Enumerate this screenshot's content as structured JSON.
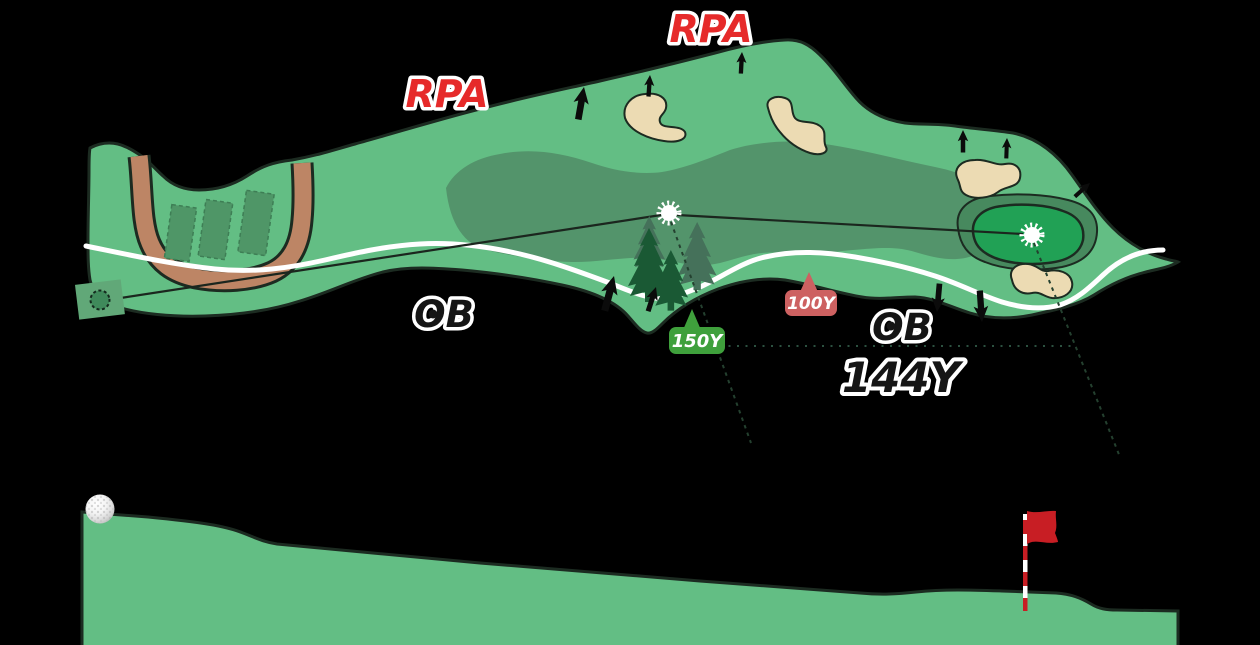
{
  "scene": {
    "background": "#000000",
    "description": "Golf hole layout: overhead course map with yardage guides and side elevation profile"
  },
  "map": {
    "rpa_labels": [
      {
        "text": "RPA"
      },
      {
        "text": "RPA"
      }
    ],
    "ob_labels": [
      {
        "text": "OB"
      },
      {
        "text": "OB"
      }
    ],
    "yardage_badges": [
      {
        "text": "150Y",
        "color": "#3FA03C"
      },
      {
        "text": "100Y",
        "color": "#CD6161"
      }
    ],
    "shot_distance": {
      "text": "144Y"
    }
  },
  "colors": {
    "background": "#000000",
    "rough": "#63BE84",
    "fairway": "#53946B",
    "collar": "#47895E",
    "green": "#21A155",
    "sand": "#ECDBB3",
    "sand_outline": "#1C2B21",
    "cart_path_dirt": "#BD8565",
    "cart_path_white": "#FFFFFF",
    "tee_box": "#4F9667",
    "tee_mat": "#61A878",
    "tee_circle": "#3F8A5B",
    "outline": "#1C2B21",
    "rpa_red": "#E62A2A",
    "ob_black": "#151515",
    "dist_black": "#151515",
    "arrow": "#0B0B0B",
    "tree_dark": "#1A5934",
    "tree_light": "#45715A",
    "flag_red": "#C81E24",
    "guide_line": "#1B261E",
    "guide_dashed": "#24402F",
    "guide_dotted": "#2C5140",
    "marker_white": "#FFFFFF"
  },
  "icons": {
    "aim_point_marker": "white scalloped circle",
    "hole_point_marker": "white scalloped circle",
    "slope_arrow": "black slope-direction arrow",
    "pine_tree": "pine tree silhouette",
    "golf_ball": "white dimpled golf ball",
    "pin_flag": "red flag on red-white striped pole"
  }
}
